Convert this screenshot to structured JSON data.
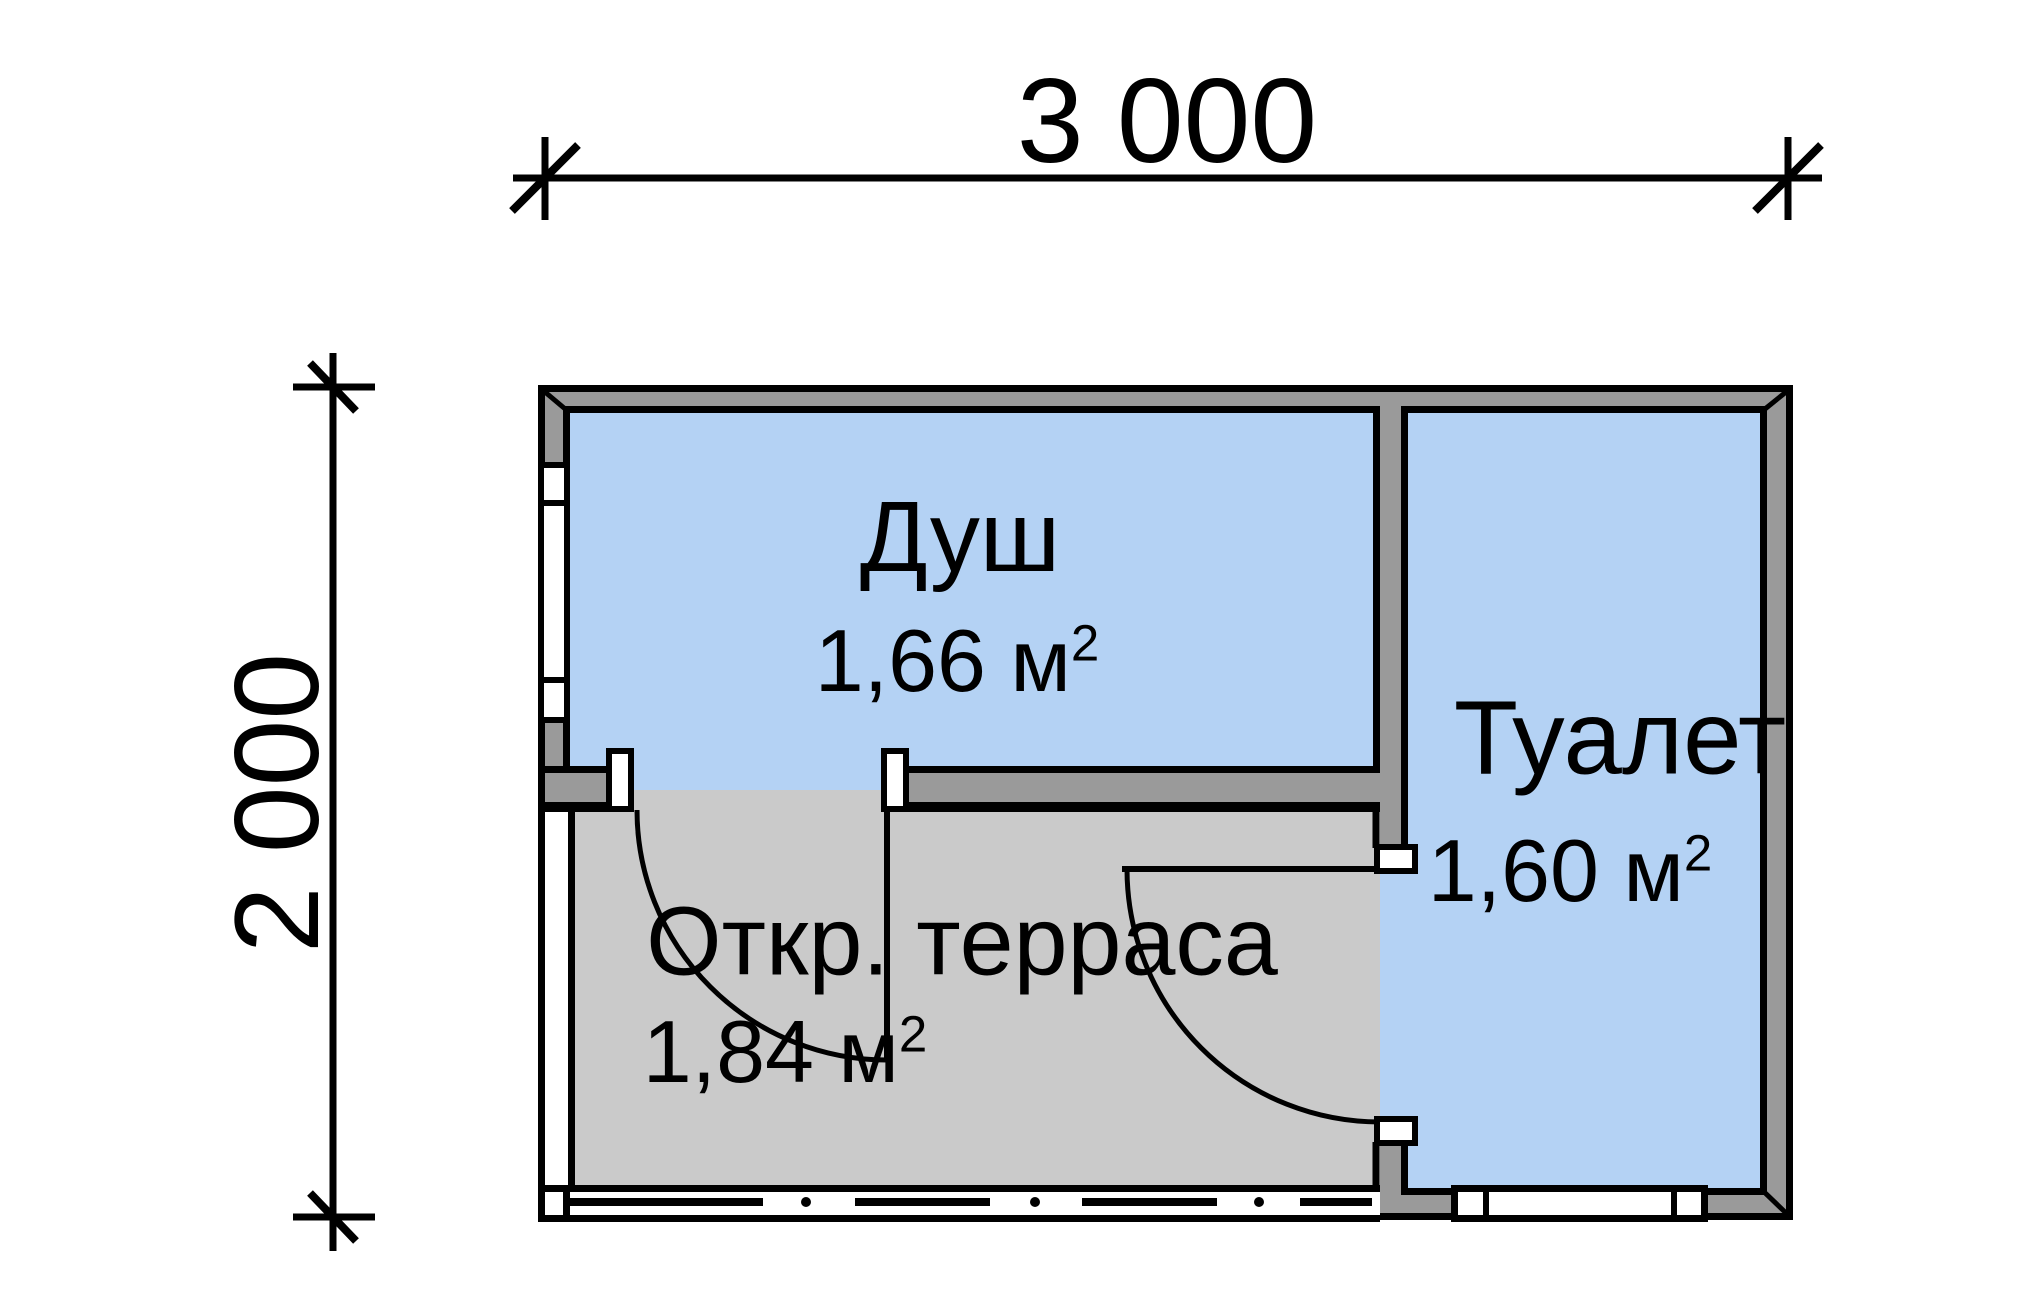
{
  "title": "Floor plan of a small outbuilding (shower, toilet, open terrace)",
  "dimensions": {
    "width_label": "3 000",
    "height_label": "2 000"
  },
  "rooms": [
    {
      "id": "shower",
      "name": "Душ",
      "area_value": "1,66 м",
      "area_exponent": "2",
      "fill": "#b4d2f4"
    },
    {
      "id": "toilet",
      "name": "Туалет",
      "area_value": "1,60 м",
      "area_exponent": "2",
      "fill": "#b4d2f4"
    },
    {
      "id": "terrace",
      "name": "Откр. терраса",
      "area_value": "1,84 м",
      "area_exponent": "2",
      "fill": "#cacaca"
    }
  ],
  "colors": {
    "wall": "#9a9a9a",
    "room_blue": "#b4d2f4",
    "terrace_gray": "#cacaca",
    "line": "#000000",
    "background": "#ffffff"
  }
}
